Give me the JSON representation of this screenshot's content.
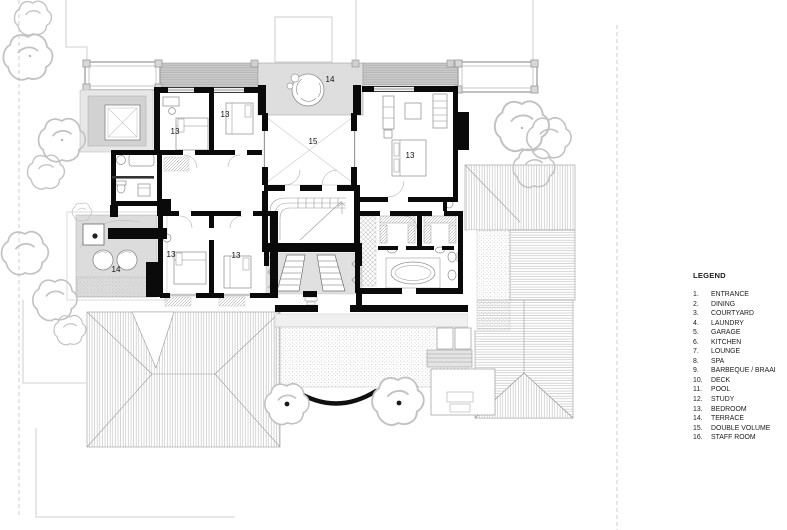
{
  "plan": {
    "labels": {
      "bedroom": "13",
      "terrace": "14",
      "double_volume": "15"
    },
    "colors": {
      "wall": "#0a0a0a",
      "paper": "#ffffff"
    }
  },
  "legend": {
    "title": "LEGEND",
    "items": [
      {
        "num": "1.",
        "label": "ENTRANCE"
      },
      {
        "num": "2.",
        "label": "DINING"
      },
      {
        "num": "3.",
        "label": "COURTYARD"
      },
      {
        "num": "4.",
        "label": "LAUNDRY"
      },
      {
        "num": "5.",
        "label": "GARAGE"
      },
      {
        "num": "6.",
        "label": "KITCHEN"
      },
      {
        "num": "7.",
        "label": "LOUNGE"
      },
      {
        "num": "8.",
        "label": "SPA"
      },
      {
        "num": "9.",
        "label": "BARBEQUE / BRAAI"
      },
      {
        "num": "10.",
        "label": "DECK"
      },
      {
        "num": "11.",
        "label": "POOL"
      },
      {
        "num": "12.",
        "label": "STUDY"
      },
      {
        "num": "13.",
        "label": "BEDROOM"
      },
      {
        "num": "14.",
        "label": "TERRACE"
      },
      {
        "num": "15.",
        "label": "DOUBLE VOLUME"
      },
      {
        "num": "16.",
        "label": "STAFF ROOM"
      }
    ]
  }
}
